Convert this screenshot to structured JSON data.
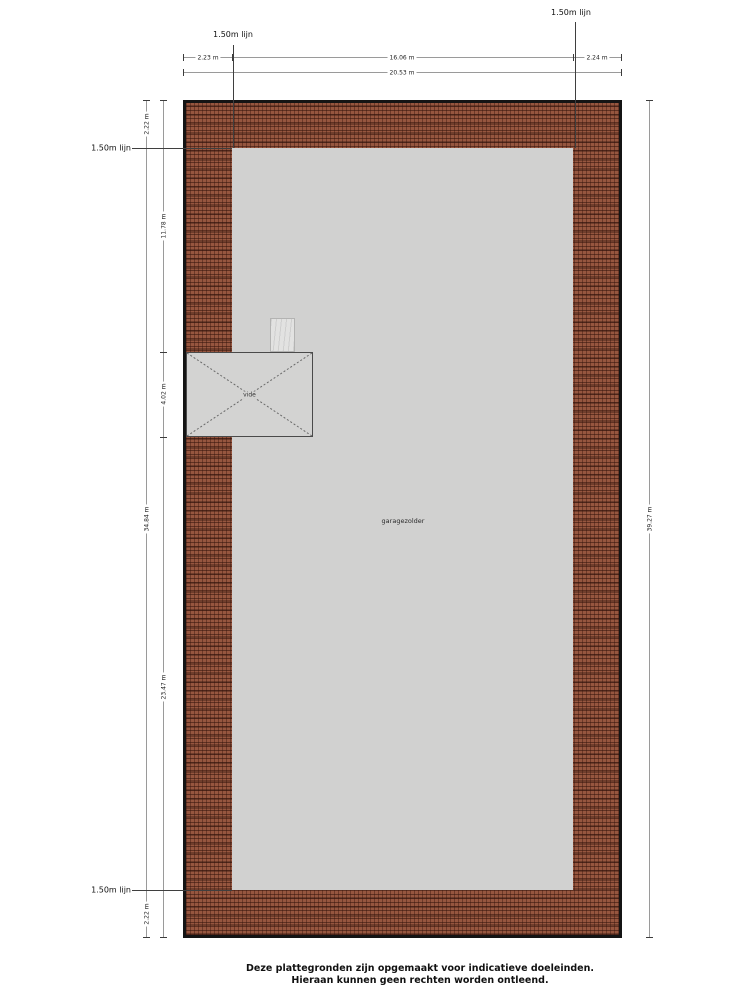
{
  "plan": {
    "level_line_label": "1.50m lijn",
    "room_label": "garagezolder",
    "vide_label": "vide",
    "dimensions": {
      "top_segments": [
        "2.23 m",
        "16.06 m",
        "2.24 m"
      ],
      "top_total": "20.53 m",
      "left_outer_segments": [
        "2.22 m",
        "34.84 m",
        "2.22 m"
      ],
      "left_inner_segments": [
        "11.78 m",
        "4.02 m",
        "23.47 m"
      ],
      "right_total": "39.27 m"
    },
    "colors": {
      "wall_fill": "#96563f",
      "wall_hatch_line": "#3a1a12",
      "floor": "#d1d1d0",
      "outline": "#141414",
      "dimension_line": "#9a9a9a"
    }
  },
  "footer": {
    "line1": "Deze plattegronden zijn opgemaakt voor indicatieve doeleinden.",
    "line2": "Hieraan kunnen geen rechten worden ontleend."
  }
}
